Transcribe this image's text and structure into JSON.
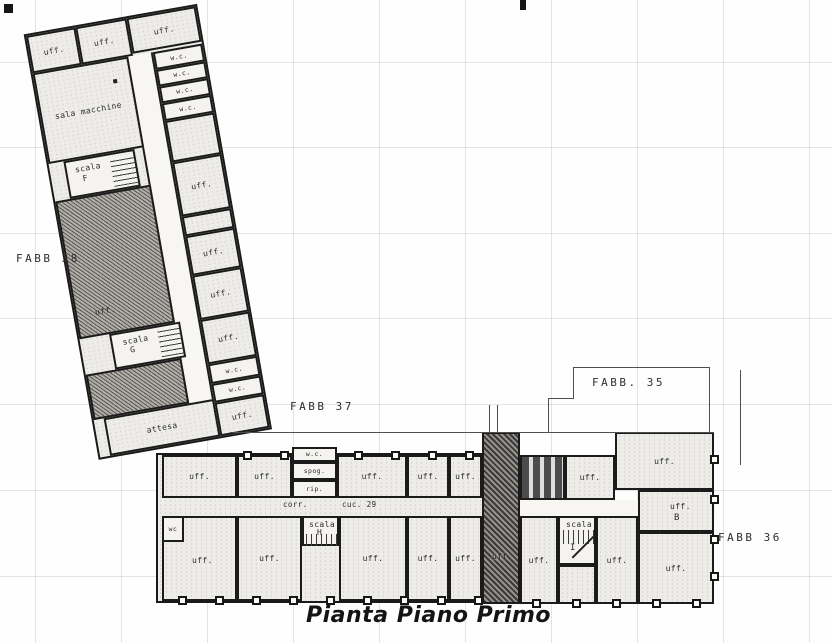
{
  "title": "Pianta Piano Primo",
  "buildings": {
    "fabb38": "FABB 38",
    "fabb37": "FABB 37",
    "fabb35": "FABB. 35",
    "fabb36": "FABB 36"
  },
  "rooms": {
    "uff": "uff.",
    "wc": "w.c.",
    "wc_short": "wc",
    "sala_macchine": "sala macchine",
    "scala": "scala",
    "attesa": "attesa",
    "spog": "spog.",
    "rip": "rip.",
    "corr": "corr.",
    "cuc29": "cuc. 29"
  },
  "letters": {
    "f": "F",
    "g": "G",
    "h": "H",
    "i": "I",
    "b": "B"
  },
  "colors": {
    "wall": "#191919",
    "paper": "#ffffff",
    "hatch_dark": "#3a3a3a",
    "grid": "#c9c9c9"
  }
}
